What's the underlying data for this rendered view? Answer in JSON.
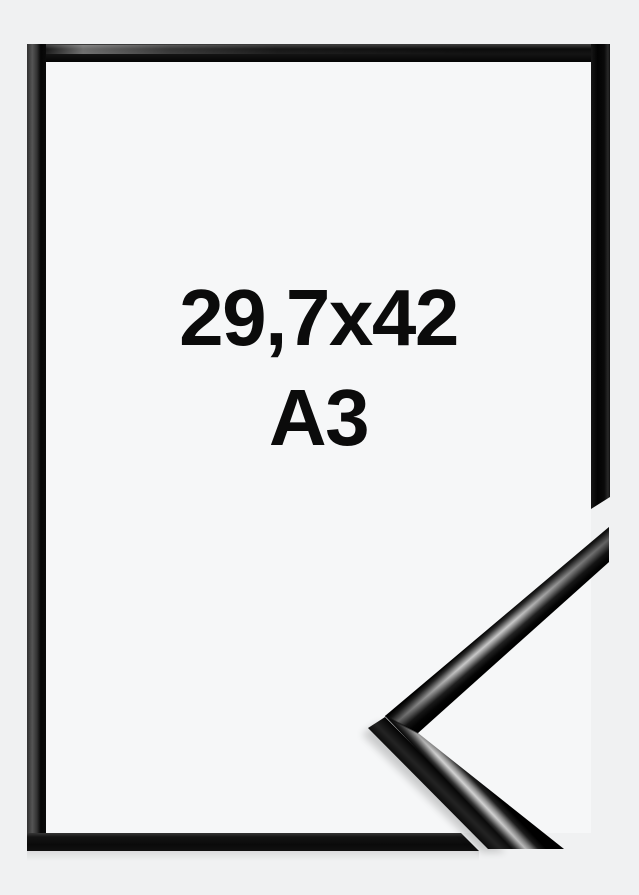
{
  "product": {
    "size_label": {
      "dimensions_cm": "29,7x42",
      "format": "A3"
    }
  },
  "colors": {
    "background": "#f0f1f2",
    "inner": "#f6f7f8",
    "frame": "#0d0d0d",
    "text": "#0b0b0b"
  }
}
